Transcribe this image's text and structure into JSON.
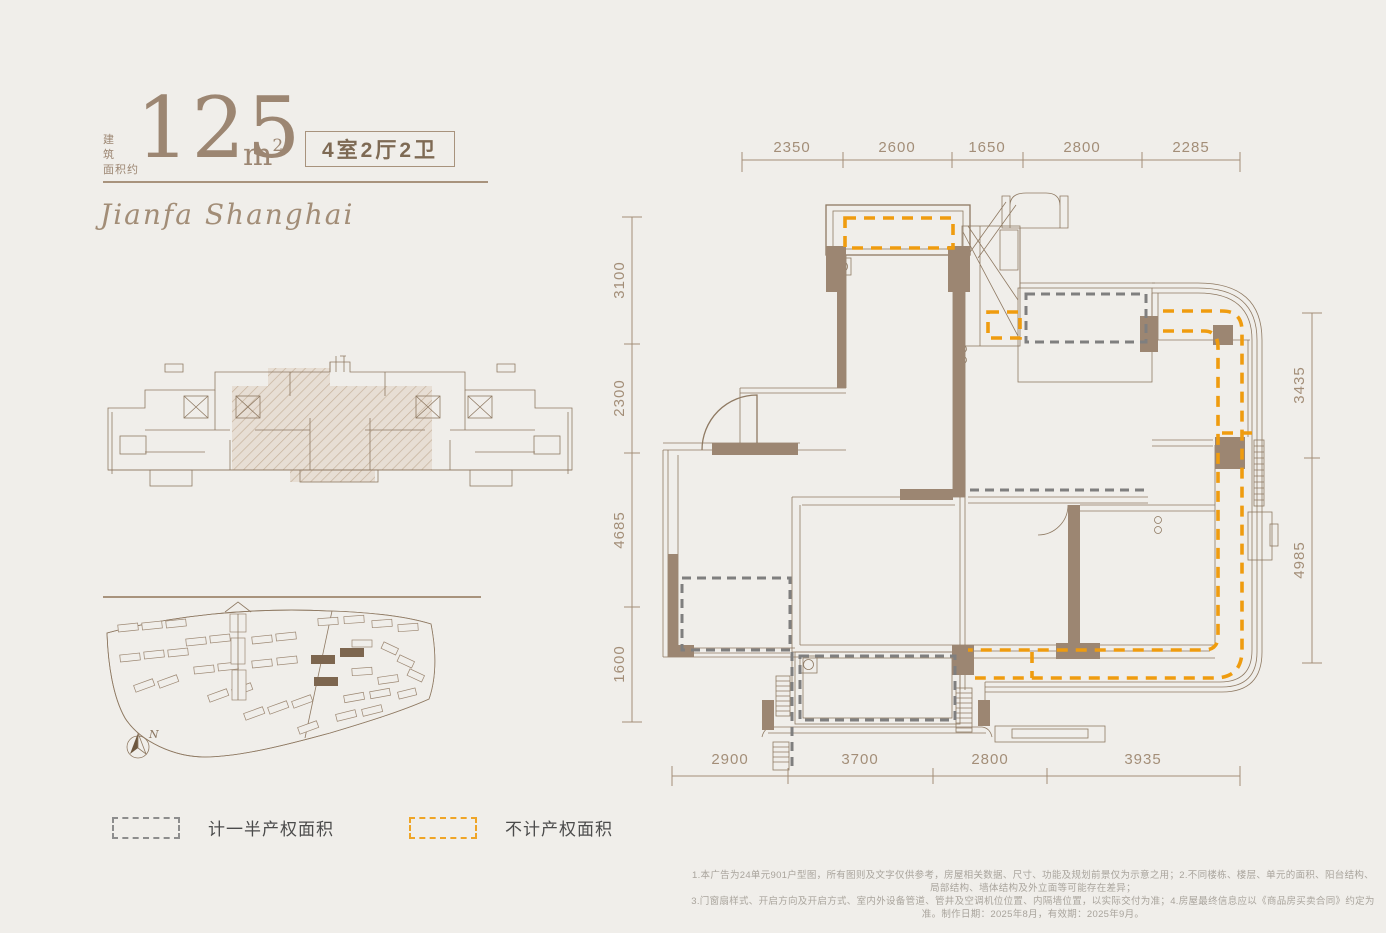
{
  "page": {
    "background": "#f0eeea",
    "accent_brown": "#9c8672",
    "accent_orange": "#ef9c0f",
    "dash_gray": "#7f7f7f"
  },
  "header": {
    "area_label_line1": "建 筑",
    "area_label_line2": "面积约",
    "area_value": "125",
    "area_unit_base": "m",
    "area_unit_sup": "2",
    "layout_badge": "4室2厅2卫",
    "brand_script": "Jianfa Shanghai"
  },
  "floorplan": {
    "dim_top": [
      "2350",
      "2600",
      "1650",
      "2800",
      "2285"
    ],
    "dim_left": [
      "3100",
      "2300",
      "4685",
      "1600"
    ],
    "dim_right": [
      "3435",
      "4985"
    ],
    "dim_bottom": [
      "2900",
      "3700",
      "2800",
      "3935"
    ]
  },
  "legend": {
    "half_property_label": "计一半产权面积",
    "excluded_label": "不计产权面积"
  },
  "siteplan": {
    "north_label": "N"
  },
  "footer": {
    "line1": "1.本广告为24单元901户型图，所有图则及文字仅供参考，房屋相关数据、尺寸、功能及规划前景仅为示意之用；2.不同楼栋、楼层、单元的面积、阳台结构、局部结构、墙体结构及外立面等可能存在差异；",
    "line2": "3.门窗扇样式、开启方向及开启方式、室内外设备管道、管井及空调机位位置、内隔墙位置，以实际交付为准；4.房屋最终信息应以《商品房买卖合同》约定为准。制作日期：2025年8月，有效期：2025年9月。"
  }
}
